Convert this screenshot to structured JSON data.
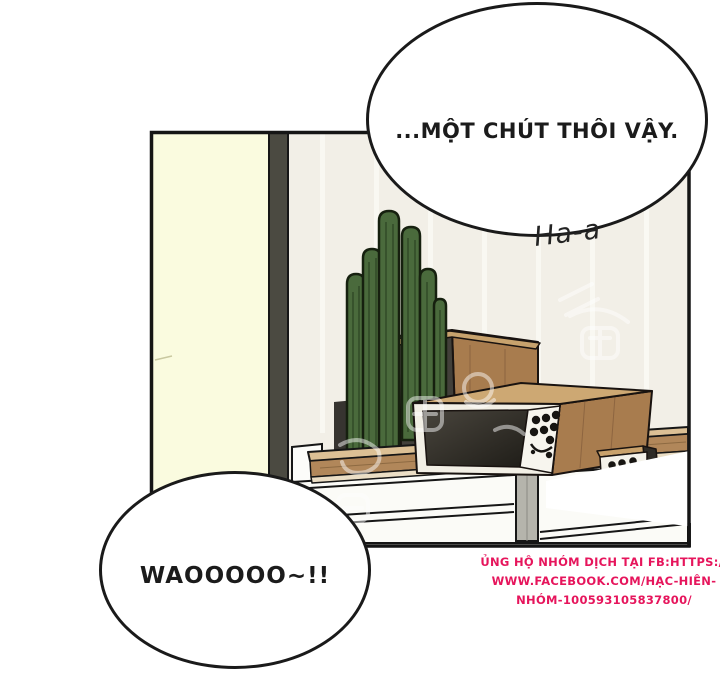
{
  "scene": {
    "bubble_top_text": "...MỘT CHÚT THÔI VẬY.",
    "sigh_sfx": "Ha-a",
    "bubble_bottom_text": "WAOOOOO~!!"
  },
  "credit": {
    "line1": "ỦNG HỘ NHÓM DỊCH TẠI FB:HTTPS://",
    "line2": "WWW.FACEBOOK.COM/HẠC-HIÊN-",
    "line3": "NHÓM-100593105837800/",
    "color": "#e6155c"
  },
  "palette": {
    "page_background": "#ffffff",
    "panel_wall": "#f2efe7",
    "door_cream": "#fafbdf",
    "door_frame_dark": "#4b4a41",
    "wood_light": "#cda873",
    "wood_mid": "#a87c4e",
    "tabletop_wood": "#b1875a",
    "cactus_green": "#4a6a3c",
    "shadow_dark": "#373430",
    "outline_black": "#161616",
    "credit_pink": "#e6155c"
  }
}
